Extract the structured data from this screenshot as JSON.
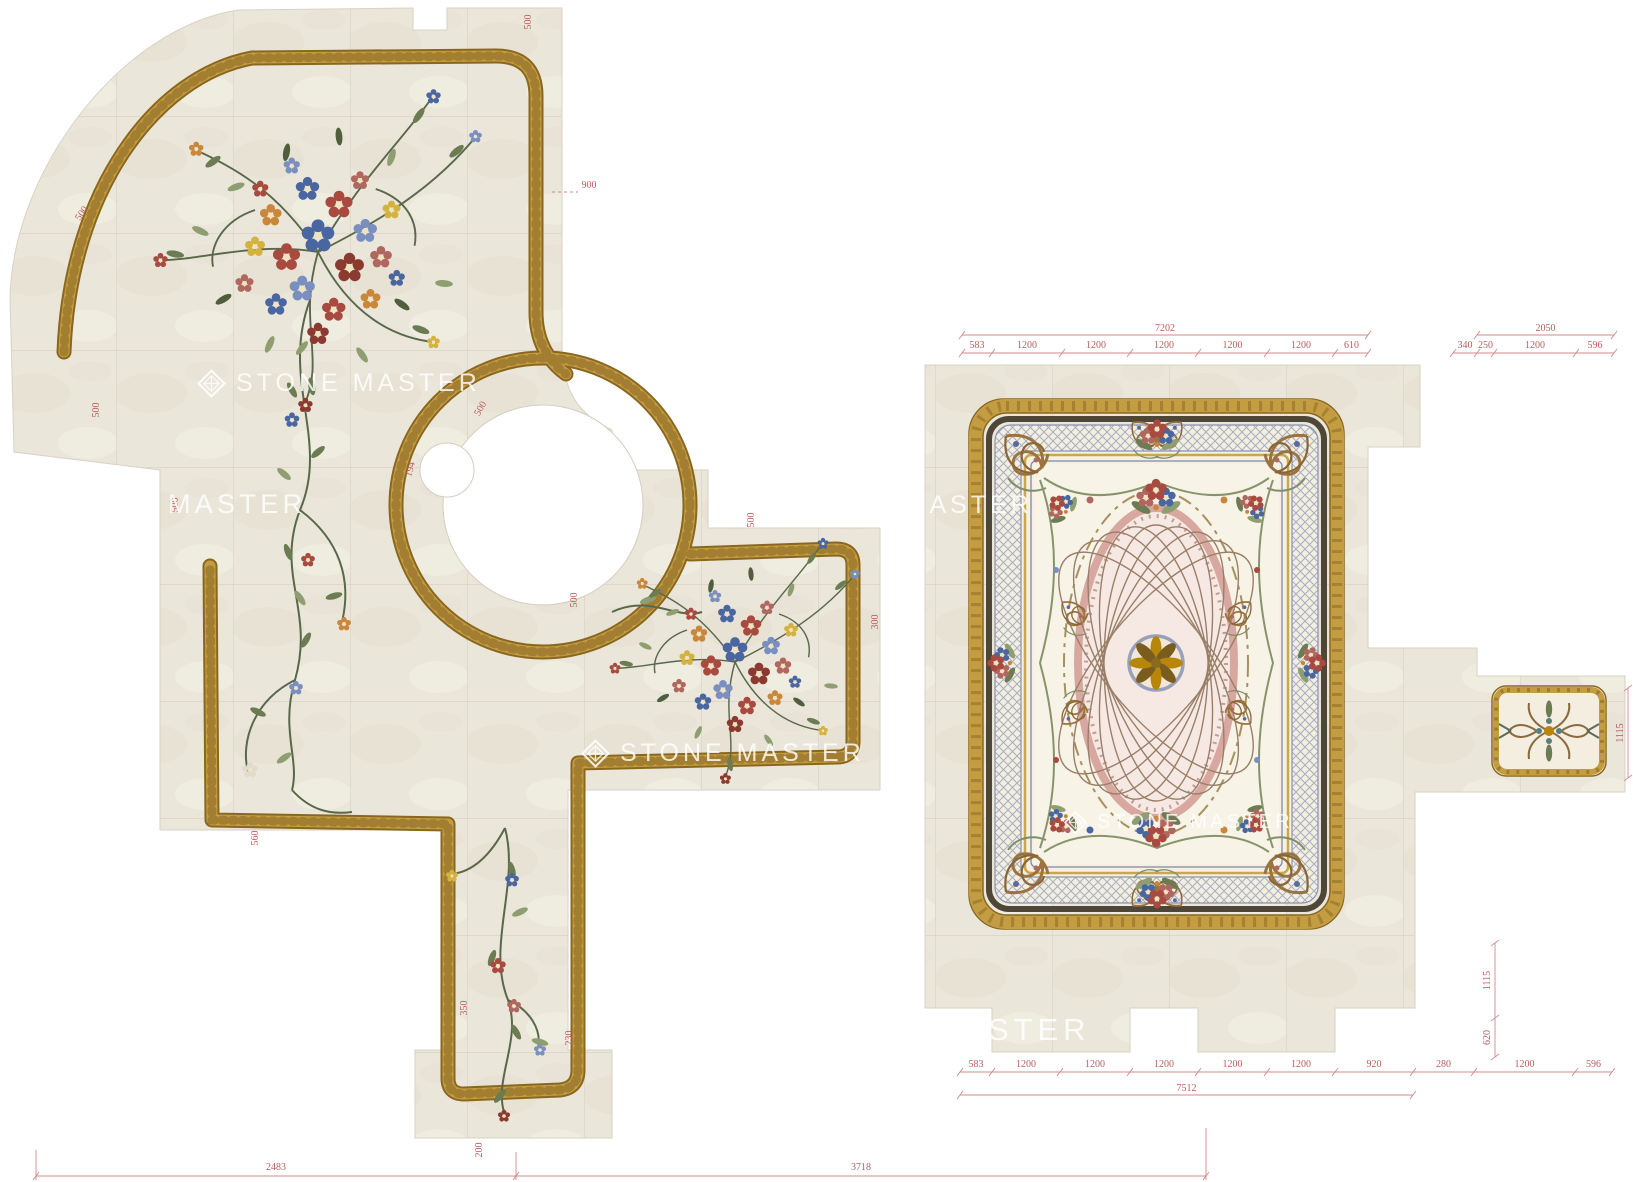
{
  "watermark_brand": "STONE MASTER",
  "watermark_logo_icon": "diamond-gem-icon",
  "watermarks": [
    {
      "text": "STONE MASTER",
      "logo": true,
      "x": 196,
      "y": 368,
      "size": 25
    },
    {
      "text": "MASTER",
      "logo": false,
      "x": 168,
      "y": 489,
      "size": 27
    },
    {
      "text": "STONE MASTER",
      "logo": true,
      "x": 748,
      "y": 490,
      "size": 25
    },
    {
      "text": "STONE MASTER",
      "logo": true,
      "x": 580,
      "y": 738,
      "size": 25
    },
    {
      "text": "STONE MASTER",
      "logo": true,
      "x": 1063,
      "y": 810,
      "size": 20
    },
    {
      "text": "STER",
      "logo": false,
      "x": 988,
      "y": 1012,
      "size": 31
    }
  ],
  "dimensions": {
    "top_left_group": {
      "overall": "7202",
      "segments": [
        "583",
        "1200",
        "1200",
        "1200",
        "1200",
        "1200",
        "610"
      ]
    },
    "top_right_group": {
      "overall": "2050",
      "segments": [
        "340",
        "250",
        "1200",
        "596"
      ]
    },
    "bottom_group": {
      "overall": "7512",
      "segments": [
        "583",
        "1200",
        "1200",
        "1200",
        "1200",
        "1200",
        "920",
        "280",
        "1200",
        "596"
      ]
    },
    "right_side_segments": [
      "1115",
      "620"
    ],
    "far_right_segments": [
      "1115"
    ],
    "left_bottom_segments": [
      "2483",
      "3718"
    ],
    "edge_labels": [
      "500",
      "900",
      "500",
      "500",
      "500",
      "194",
      "500",
      "500",
      "500",
      "300",
      "560",
      "350",
      "230",
      "200"
    ]
  },
  "colors": {
    "background": "#ffffff",
    "tile_beige": "#ebe6da",
    "grout": "#d7d0c1",
    "gold_border": "#c49d42",
    "gold_edge": "#8a671f",
    "dimension_red": "#b85c5c",
    "watermark_white": "#ffffff",
    "vine_green": "#5a684a",
    "flower_red": "#a84a3f",
    "flower_blue": "#4a66a0",
    "lattice_blue": "#8a93b0",
    "medallion_pink": "#d8a8a0"
  }
}
